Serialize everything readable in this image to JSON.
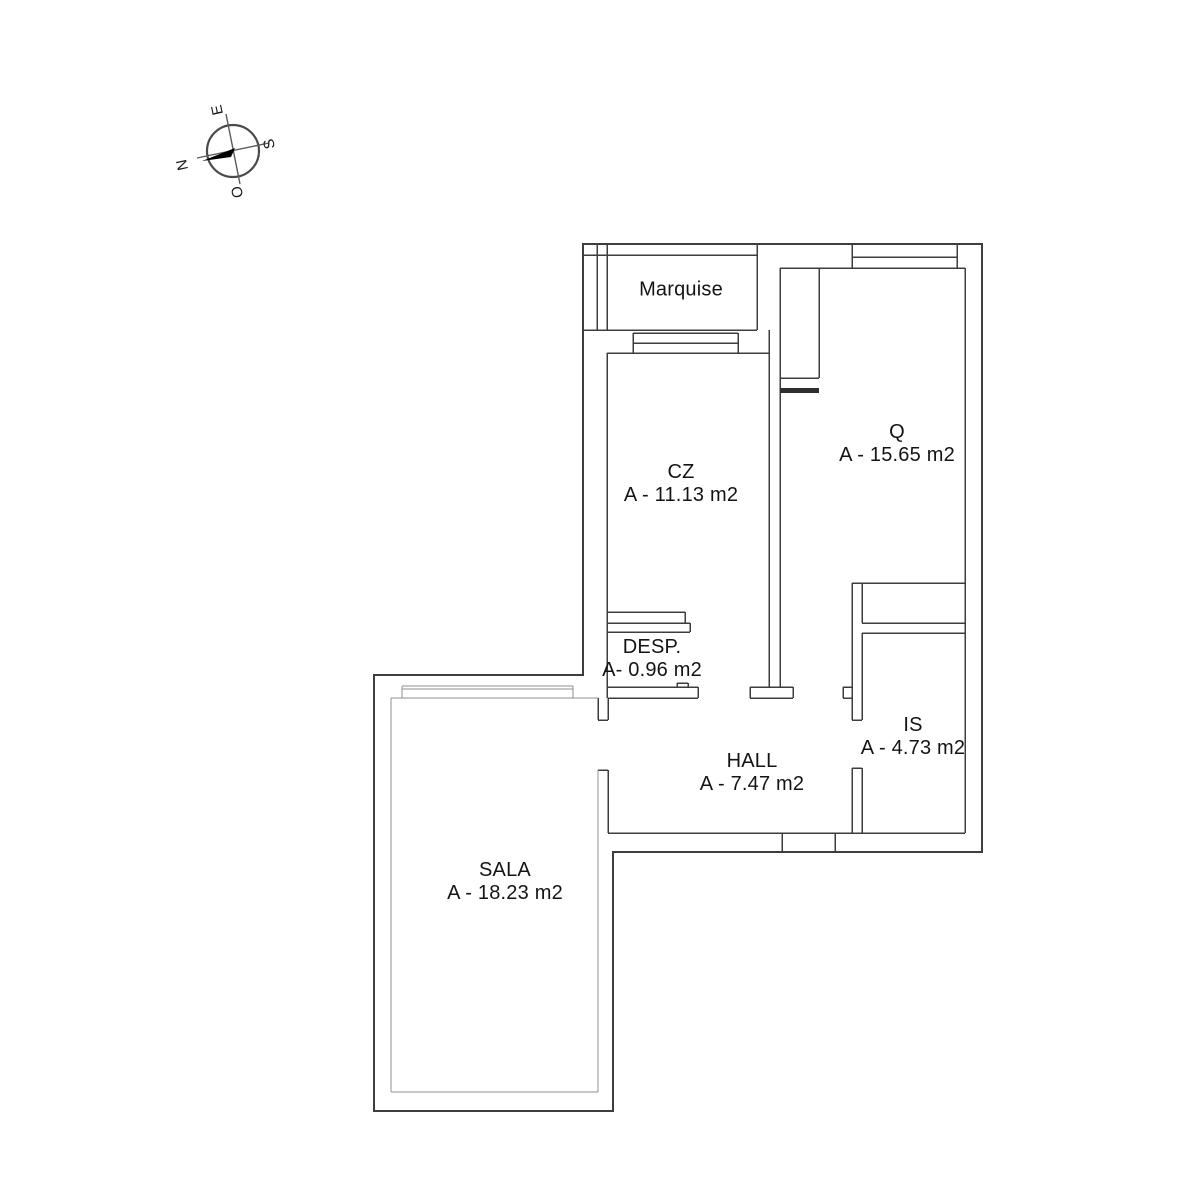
{
  "compass": {
    "labels": {
      "e": "E",
      "s": "S",
      "n": "N",
      "o": "O"
    }
  },
  "rooms": [
    {
      "name": "Marquise",
      "area": ""
    },
    {
      "name": "CZ",
      "area": "A - 11.13 m2"
    },
    {
      "name": "Q",
      "area": "A - 15.65 m2"
    },
    {
      "name": "DESP.",
      "area": "A- 0.96 m2"
    },
    {
      "name": "HALL",
      "area": "A - 7.47 m2"
    },
    {
      "name": "IS",
      "area": "A - 4.73 m2"
    },
    {
      "name": "SALA",
      "area": "A - 18.23 m2"
    }
  ],
  "colors": {
    "background": "#ffffff",
    "wall_dark": "#3d3d3d",
    "wall_light": "#8f8f8f",
    "text": "#141414",
    "needle": "#000000"
  }
}
